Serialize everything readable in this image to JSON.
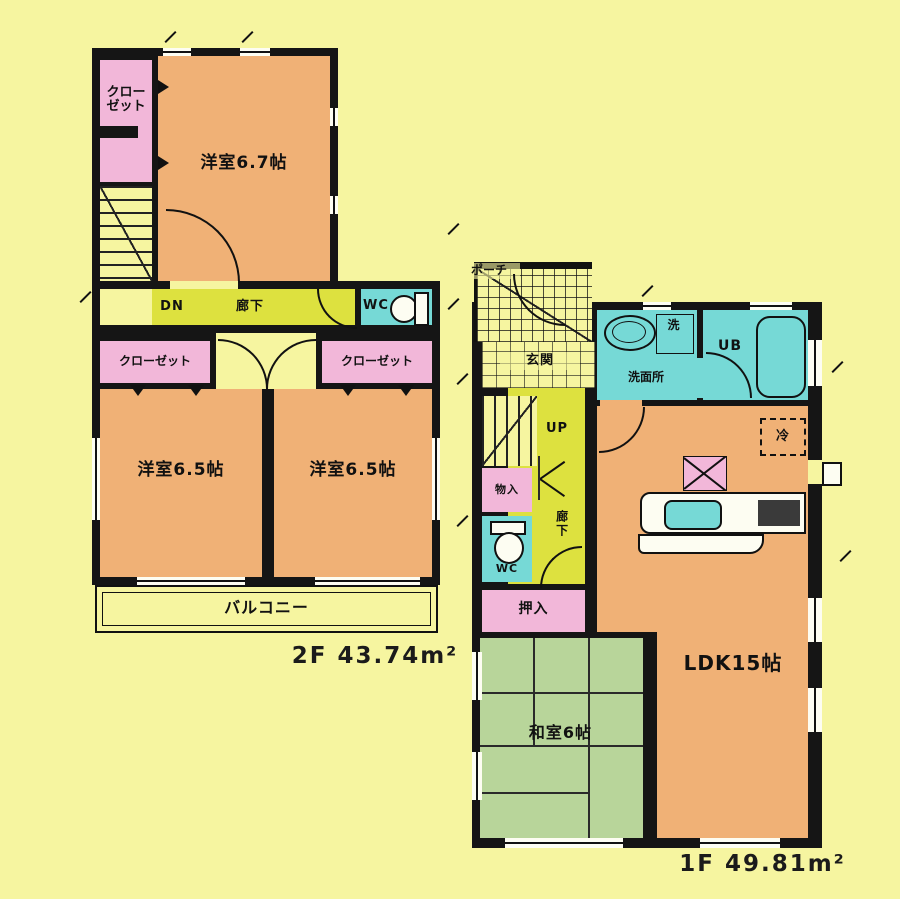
{
  "floor2": {
    "area_label": "2F 43.74m²",
    "closet_top": "クローゼット",
    "room_67": "洋室6.7帖",
    "stairs_dn": "DN",
    "hallway": "廊下",
    "wc": "WC",
    "closet_left": "クローゼット",
    "closet_right": "クローゼット",
    "room_65_left": "洋室6.5帖",
    "room_65_right": "洋室6.5帖",
    "balcony": "バルコニー"
  },
  "floor1": {
    "area_label": "1F 49.81m²",
    "porch": "ポーチ",
    "entrance": "玄関",
    "stairs_up": "UP",
    "hallway": "廊下",
    "storage": "物入",
    "wc": "WC",
    "washroom": "洗面所",
    "laundry": "洗",
    "unit_bath": "UB",
    "refrigerator": "冷",
    "oshiire": "押入",
    "japanese_room": "和室6帖",
    "ldk": "LDK15帖"
  },
  "colors": {
    "background": "#f6f5a0",
    "wall": "#151515",
    "room_orange": "#f0b176",
    "closet_pink": "#f2b7d9",
    "hall_yellow_green": "#dde13f",
    "water_cyan": "#76d9d6",
    "tatami_green": "#b8d59a"
  }
}
